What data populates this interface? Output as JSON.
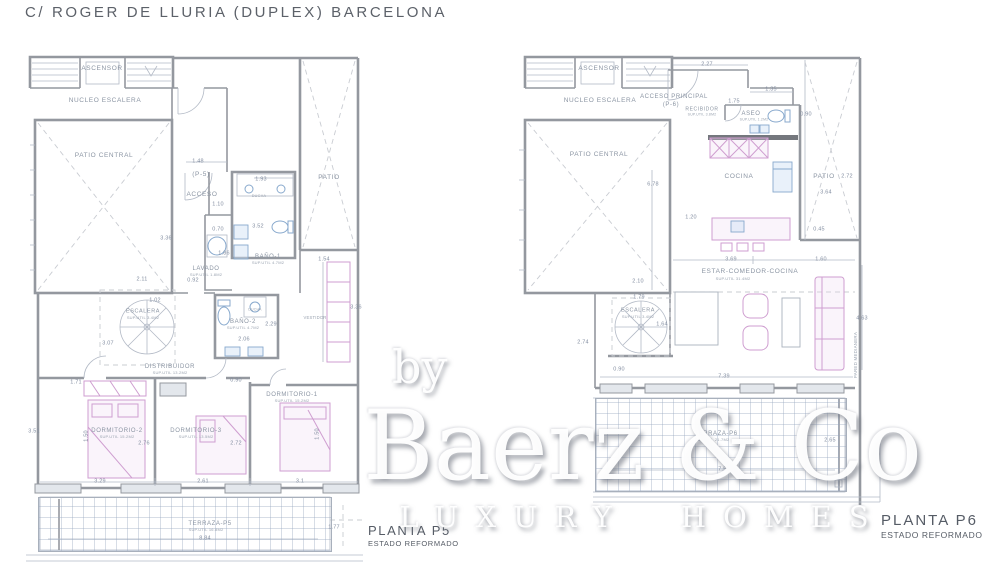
{
  "title": "C/ ROGER DE LLURIA  (DUPLEX) BARCELONA",
  "watermark": {
    "by": "by",
    "name": "Baerz & Co",
    "tagline": "LUXURY HOMES"
  },
  "plans": {
    "p5": {
      "caption": "PLANTA P5",
      "caption_sub": "ESTADO REFORMADO",
      "labels": [
        {
          "t": "ASCENSOR",
          "x": 102,
          "y": 69,
          "c": "room"
        },
        {
          "t": "NUCLEO ESCALERA",
          "x": 105,
          "y": 101,
          "c": "room"
        },
        {
          "t": "PATIO CENTRAL",
          "x": 104,
          "y": 156,
          "c": "room"
        },
        {
          "t": "PATIO",
          "x": 329,
          "y": 178,
          "c": "room"
        },
        {
          "t": "(P-5)",
          "x": 201,
          "y": 175,
          "c": "room"
        },
        {
          "t": "ACCESO",
          "x": 202,
          "y": 195,
          "c": "room"
        },
        {
          "t": "DUCHA",
          "x": 259,
          "y": 197,
          "c": "sub",
          "s": 3.8
        },
        {
          "t": "BAÑO-1",
          "x": 268,
          "y": 257,
          "c": "room",
          "s": 6
        },
        {
          "t": "SUP.UTIL 4.7M2",
          "x": 268,
          "y": 263,
          "c": "sub"
        },
        {
          "t": "LAVADO",
          "x": 206,
          "y": 269,
          "c": "room",
          "s": 6
        },
        {
          "t": "SUP.UTIL 1.8M2",
          "x": 206,
          "y": 275,
          "c": "sub"
        },
        {
          "t": "ESCALERA",
          "x": 143,
          "y": 312,
          "c": "room",
          "s": 5.5
        },
        {
          "t": "SUP.UTIL 3.4M2",
          "x": 143,
          "y": 318,
          "c": "sub"
        },
        {
          "t": "BAÑO-2",
          "x": 243,
          "y": 322,
          "c": "room",
          "s": 6
        },
        {
          "t": "SUP.UTIL 4.7M2",
          "x": 243,
          "y": 328,
          "c": "sub"
        },
        {
          "t": "DUCHA",
          "x": 255,
          "y": 310,
          "c": "sub",
          "s": 3.5
        },
        {
          "t": "DISTRIBUIDOR",
          "x": 170,
          "y": 367,
          "c": "room",
          "s": 6
        },
        {
          "t": "SUP.UTIL 13.2M2",
          "x": 170,
          "y": 373,
          "c": "sub"
        },
        {
          "t": "VESTIDOR",
          "x": 315,
          "y": 318,
          "c": "sub",
          "s": 4.2
        },
        {
          "t": "DORMITORIO-1",
          "x": 292,
          "y": 395,
          "c": "room",
          "s": 6
        },
        {
          "t": "SUP.UTIL 15.2M2",
          "x": 292,
          "y": 401,
          "c": "sub"
        },
        {
          "t": "DORMITORIO-2",
          "x": 117,
          "y": 431,
          "c": "room",
          "s": 6
        },
        {
          "t": "SUP.UTIL 15.2M2",
          "x": 117,
          "y": 437,
          "c": "sub"
        },
        {
          "t": "DORMITORIO-3",
          "x": 196,
          "y": 431,
          "c": "room",
          "s": 6
        },
        {
          "t": "SUP.UTIL 13.5M2",
          "x": 196,
          "y": 437,
          "c": "sub"
        },
        {
          "t": "TERRAZA-P5",
          "x": 210,
          "y": 524,
          "c": "room",
          "s": 6
        },
        {
          "t": "SUP.UTIL 16.8M2",
          "x": 206,
          "y": 530,
          "c": "sub"
        },
        {
          "t": "1.48",
          "x": 198,
          "y": 162,
          "c": "dim"
        },
        {
          "t": "1.93",
          "x": 261,
          "y": 180,
          "c": "dim"
        },
        {
          "t": "1.10",
          "x": 218,
          "y": 205,
          "c": "dim"
        },
        {
          "t": "0.70",
          "x": 218,
          "y": 230,
          "c": "dim"
        },
        {
          "t": "3.52",
          "x": 258,
          "y": 227,
          "c": "dim"
        },
        {
          "t": "1.86",
          "x": 224,
          "y": 254,
          "c": "dim"
        },
        {
          "t": "0.92",
          "x": 193,
          "y": 281,
          "c": "dim"
        },
        {
          "t": "2.11",
          "x": 142,
          "y": 280,
          "c": "dim"
        },
        {
          "t": "1.02",
          "x": 155,
          "y": 301,
          "c": "dim"
        },
        {
          "t": "3.07",
          "x": 108,
          "y": 344,
          "c": "dim"
        },
        {
          "t": "3.36",
          "x": 166,
          "y": 239,
          "c": "dim"
        },
        {
          "t": "1.54",
          "x": 324,
          "y": 260,
          "c": "dim"
        },
        {
          "t": "2.29",
          "x": 271,
          "y": 325,
          "c": "dim"
        },
        {
          "t": "2.06",
          "x": 244,
          "y": 340,
          "c": "dim"
        },
        {
          "t": "0.90",
          "x": 236,
          "y": 381,
          "c": "dim"
        },
        {
          "t": "3.36",
          "x": 356,
          "y": 308,
          "c": "dim"
        },
        {
          "t": "1.71",
          "x": 76,
          "y": 383,
          "c": "dim"
        },
        {
          "t": "3.51",
          "x": 34,
          "y": 432,
          "c": "dim"
        },
        {
          "t": "2.76",
          "x": 144,
          "y": 444,
          "c": "dim"
        },
        {
          "t": "2.72",
          "x": 236,
          "y": 444,
          "c": "dim"
        },
        {
          "t": "1.50",
          "x": 87,
          "y": 436,
          "c": "dim",
          "r": -90
        },
        {
          "t": "1.50",
          "x": 318,
          "y": 434,
          "c": "dim",
          "r": -90
        },
        {
          "t": "3.29",
          "x": 100,
          "y": 482,
          "c": "dim"
        },
        {
          "t": "2.61",
          "x": 203,
          "y": 482,
          "c": "dim"
        },
        {
          "t": "3.1",
          "x": 300,
          "y": 482,
          "c": "dim"
        },
        {
          "t": "8.84",
          "x": 205,
          "y": 539,
          "c": "dim"
        },
        {
          "t": "1.77",
          "x": 334,
          "y": 528,
          "c": "dim"
        }
      ]
    },
    "p6": {
      "caption": "PLANTA P6",
      "caption_sub": "ESTADO REFORMADO",
      "labels": [
        {
          "t": "ASCENSOR",
          "x": 599,
          "y": 69,
          "c": "room"
        },
        {
          "t": "NUCLEO ESCALERA",
          "x": 600,
          "y": 101,
          "c": "room"
        },
        {
          "t": "ACCESO PRINCIPAL",
          "x": 674,
          "y": 97,
          "c": "room",
          "s": 6
        },
        {
          "t": "(P-6)",
          "x": 671,
          "y": 105,
          "c": "room",
          "s": 6
        },
        {
          "t": "RECIBIDOR",
          "x": 702,
          "y": 110,
          "c": "room",
          "s": 5
        },
        {
          "t": "SUP.UTIL 3.8M2",
          "x": 702,
          "y": 115,
          "c": "sub",
          "s": 3.5
        },
        {
          "t": "ASEO",
          "x": 751,
          "y": 114,
          "c": "room",
          "s": 6
        },
        {
          "t": "SUP.UTIL 1.2M2",
          "x": 754,
          "y": 120,
          "c": "sub",
          "s": 3.5
        },
        {
          "t": "PATIO CENTRAL",
          "x": 599,
          "y": 155,
          "c": "room"
        },
        {
          "t": "PATIO",
          "x": 824,
          "y": 177,
          "c": "room"
        },
        {
          "t": "COCINA",
          "x": 739,
          "y": 177,
          "c": "room"
        },
        {
          "t": "ESTAR-COMEDOR-COCINA",
          "x": 750,
          "y": 272,
          "c": "room",
          "s": 6.5
        },
        {
          "t": "SUP.UTIL 31.4M2",
          "x": 733,
          "y": 279,
          "c": "sub"
        },
        {
          "t": "ESCALERA",
          "x": 638,
          "y": 311,
          "c": "room",
          "s": 5.5
        },
        {
          "t": "SUP.UTIL 3.4M2",
          "x": 638,
          "y": 317,
          "c": "sub"
        },
        {
          "t": "TERRAZA-P6",
          "x": 716,
          "y": 434,
          "c": "room",
          "s": 6
        },
        {
          "t": "SUP.UTIL 21.7M2",
          "x": 712,
          "y": 440,
          "c": "sub"
        },
        {
          "t": "PARED MEDIANERA",
          "x": 856,
          "y": 355,
          "c": "sub",
          "s": 4.5,
          "r": -90
        },
        {
          "t": "2.27",
          "x": 707,
          "y": 65,
          "c": "dim"
        },
        {
          "t": "1.35",
          "x": 771,
          "y": 90,
          "c": "dim"
        },
        {
          "t": "1.75",
          "x": 734,
          "y": 102,
          "c": "dim"
        },
        {
          "t": "0.90",
          "x": 806,
          "y": 115,
          "c": "dim"
        },
        {
          "t": "6.78",
          "x": 653,
          "y": 185,
          "c": "dim"
        },
        {
          "t": "1.20",
          "x": 691,
          "y": 218,
          "c": "dim"
        },
        {
          "t": "2.72",
          "x": 847,
          "y": 177,
          "c": "dim"
        },
        {
          "t": "3.64",
          "x": 826,
          "y": 193,
          "c": "dim"
        },
        {
          "t": "0.45",
          "x": 819,
          "y": 230,
          "c": "dim"
        },
        {
          "t": "3.69",
          "x": 731,
          "y": 260,
          "c": "dim"
        },
        {
          "t": "1.60",
          "x": 821,
          "y": 260,
          "c": "dim"
        },
        {
          "t": "2.10",
          "x": 638,
          "y": 282,
          "c": "dim"
        },
        {
          "t": "1.79",
          "x": 639,
          "y": 298,
          "c": "dim"
        },
        {
          "t": "1.64",
          "x": 662,
          "y": 325,
          "c": "dim"
        },
        {
          "t": "0.90",
          "x": 619,
          "y": 370,
          "c": "dim"
        },
        {
          "t": "7.39",
          "x": 724,
          "y": 377,
          "c": "dim"
        },
        {
          "t": "4.63",
          "x": 862,
          "y": 319,
          "c": "dim"
        },
        {
          "t": "2.74",
          "x": 583,
          "y": 343,
          "c": "dim"
        },
        {
          "t": "7.50",
          "x": 724,
          "y": 470,
          "c": "dim"
        },
        {
          "t": "2.65",
          "x": 830,
          "y": 441,
          "c": "dim"
        }
      ]
    }
  }
}
